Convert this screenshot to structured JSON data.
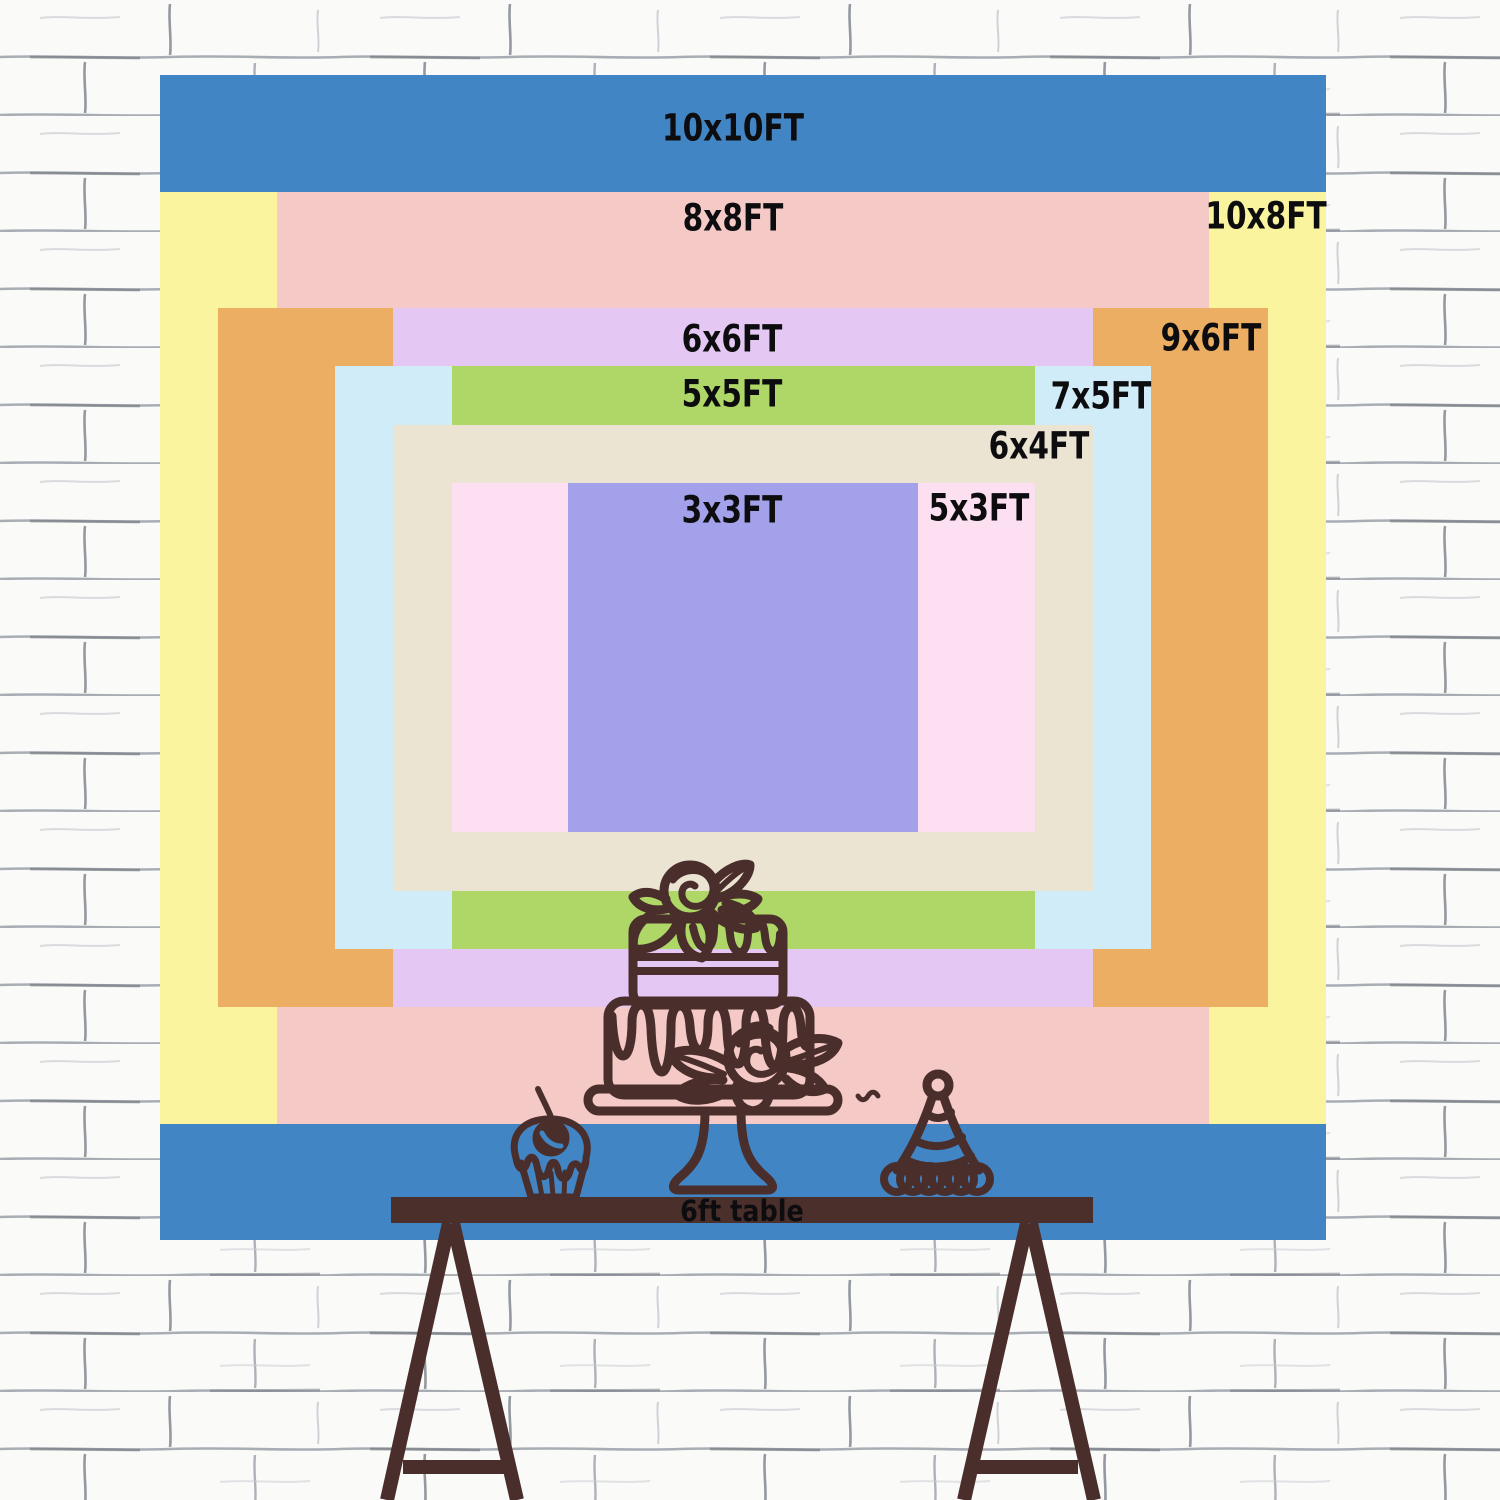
{
  "sizes": [
    {
      "id": "10x10",
      "label": "10x10FT",
      "color": "#4285c4"
    },
    {
      "id": "10x8",
      "label": "10x8FT",
      "color": "#fbf49e"
    },
    {
      "id": "8x8",
      "label": "8x8FT",
      "color": "#f4c9c6"
    },
    {
      "id": "9x6",
      "label": "9x6FT",
      "color": "#ecae62"
    },
    {
      "id": "6x6",
      "label": "6x6FT",
      "color": "#e4c7f2"
    },
    {
      "id": "7x5",
      "label": "7x5FT",
      "color": "#cfecf8"
    },
    {
      "id": "5x5",
      "label": "5x5FT",
      "color": "#aed768"
    },
    {
      "id": "6x4",
      "label": "6x4FT",
      "color": "#ebe4d2"
    },
    {
      "id": "5x3",
      "label": "5x3FT",
      "color": "#fcdff1"
    },
    {
      "id": "3x3",
      "label": "3x3FT",
      "color": "#a2a1e9"
    }
  ],
  "table": {
    "label": "6ft table",
    "color": "#4a2f2b"
  },
  "colors": {
    "line": "#4a2e2b",
    "label-text": "#0d0d10",
    "blue": "#4285c4",
    "wall-base": "#fafaf8",
    "wall-mortar": "#9aa0a8"
  }
}
